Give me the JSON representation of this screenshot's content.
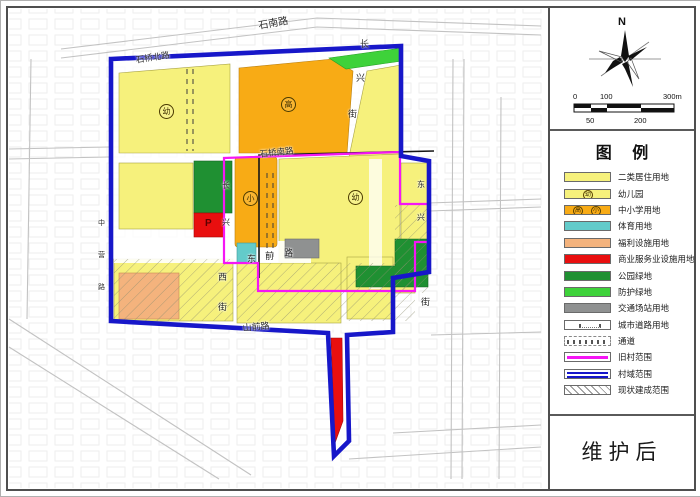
{
  "title_block": {
    "text": "维护后"
  },
  "compass": {
    "north_label": "N"
  },
  "scalebar": {
    "labels_top": [
      "0",
      "100",
      "300m"
    ],
    "labels_bottom": [
      "50",
      "200"
    ]
  },
  "legend": {
    "title": "图  例",
    "items": [
      {
        "label": "二类居住用地",
        "type": "fill",
        "color": "#f6f17c"
      },
      {
        "label": "幼儿园",
        "type": "fill-badge",
        "color": "#f6f17c",
        "badges": [
          "幼"
        ]
      },
      {
        "label": "中小学用地",
        "type": "fill-badges",
        "color": "#f8ab15",
        "badges": [
          "高",
          "小"
        ]
      },
      {
        "label": "体育用地",
        "type": "fill",
        "color": "#63cbca"
      },
      {
        "label": "福利设施用地",
        "type": "fill",
        "color": "#f4b37d"
      },
      {
        "label": "商业服务业设施用地",
        "type": "fill",
        "color": "#e90f0f"
      },
      {
        "label": "公园绿地",
        "type": "fill",
        "color": "#1f9032"
      },
      {
        "label": "防护绿地",
        "type": "fill",
        "color": "#3ed23a"
      },
      {
        "label": "交通场站用地",
        "type": "fill",
        "color": "#8f9191"
      },
      {
        "label": "城市道路用地",
        "type": "road"
      },
      {
        "label": "通道",
        "type": "dashes"
      },
      {
        "label": "旧村范围",
        "type": "line",
        "color": "#f516f5"
      },
      {
        "label": "村域范围",
        "type": "line2",
        "color": "#1717c9"
      },
      {
        "label": "现状建成范围",
        "type": "hatch"
      }
    ]
  },
  "map": {
    "colors": {
      "residential": "#f6f17c",
      "school": "#f8ab15",
      "sports": "#63cbca",
      "welfare": "#f4b37d",
      "commercial": "#e90f0f",
      "park_green": "#1f9032",
      "buffer_green": "#3ed23a",
      "transport": "#8f9191",
      "village_boundary": "#1717c9",
      "old_village_boundary": "#f516f5"
    },
    "parking_label": "P",
    "road_labels": [
      {
        "text": "石南路",
        "x": 256,
        "y": 16,
        "rot": -10,
        "size": 10
      },
      {
        "text": "石桥北路",
        "x": 134,
        "y": 53,
        "rot": -9,
        "size": 8.5
      },
      {
        "text": "长",
        "x": 359,
        "y": 36,
        "rot": 0,
        "size": 9
      },
      {
        "text": "兴",
        "x": 355,
        "y": 70,
        "rot": 0,
        "size": 9
      },
      {
        "text": "街",
        "x": 347,
        "y": 106,
        "rot": 0,
        "size": 9
      },
      {
        "text": "石桥南路",
        "x": 258,
        "y": 147,
        "rot": -6,
        "size": 8.5
      },
      {
        "text": "长",
        "x": 221,
        "y": 179,
        "rot": 0,
        "size": 8
      },
      {
        "text": "兴",
        "x": 221,
        "y": 216,
        "rot": 0,
        "size": 8
      },
      {
        "text": "东",
        "x": 416,
        "y": 178,
        "rot": 0,
        "size": 8
      },
      {
        "text": "兴",
        "x": 416,
        "y": 211,
        "rot": 0,
        "size": 8
      },
      {
        "text": "街",
        "x": 420,
        "y": 294,
        "rot": 0,
        "size": 9
      },
      {
        "text": "东",
        "x": 246,
        "y": 251,
        "rot": 0,
        "size": 9
      },
      {
        "text": "前",
        "x": 264,
        "y": 248,
        "rot": 0,
        "size": 9
      },
      {
        "text": "路",
        "x": 283,
        "y": 245,
        "rot": 0,
        "size": 9
      },
      {
        "text": "西",
        "x": 217,
        "y": 269,
        "rot": 0,
        "size": 9
      },
      {
        "text": "街",
        "x": 217,
        "y": 299,
        "rot": 0,
        "size": 9
      },
      {
        "text": "山前路",
        "x": 241,
        "y": 320,
        "rot": -5,
        "size": 9
      },
      {
        "text": "中",
        "x": 97,
        "y": 217,
        "rot": 0,
        "size": 7
      },
      {
        "text": "营",
        "x": 97,
        "y": 249,
        "rot": 0,
        "size": 7
      },
      {
        "text": "路",
        "x": 97,
        "y": 281,
        "rot": 0,
        "size": 7
      }
    ],
    "zone_badges": [
      {
        "text": "幼",
        "x": 165,
        "y": 110
      },
      {
        "text": "高",
        "x": 287,
        "y": 103
      },
      {
        "text": "小",
        "x": 249,
        "y": 197
      },
      {
        "text": "幼",
        "x": 354,
        "y": 196
      }
    ]
  }
}
